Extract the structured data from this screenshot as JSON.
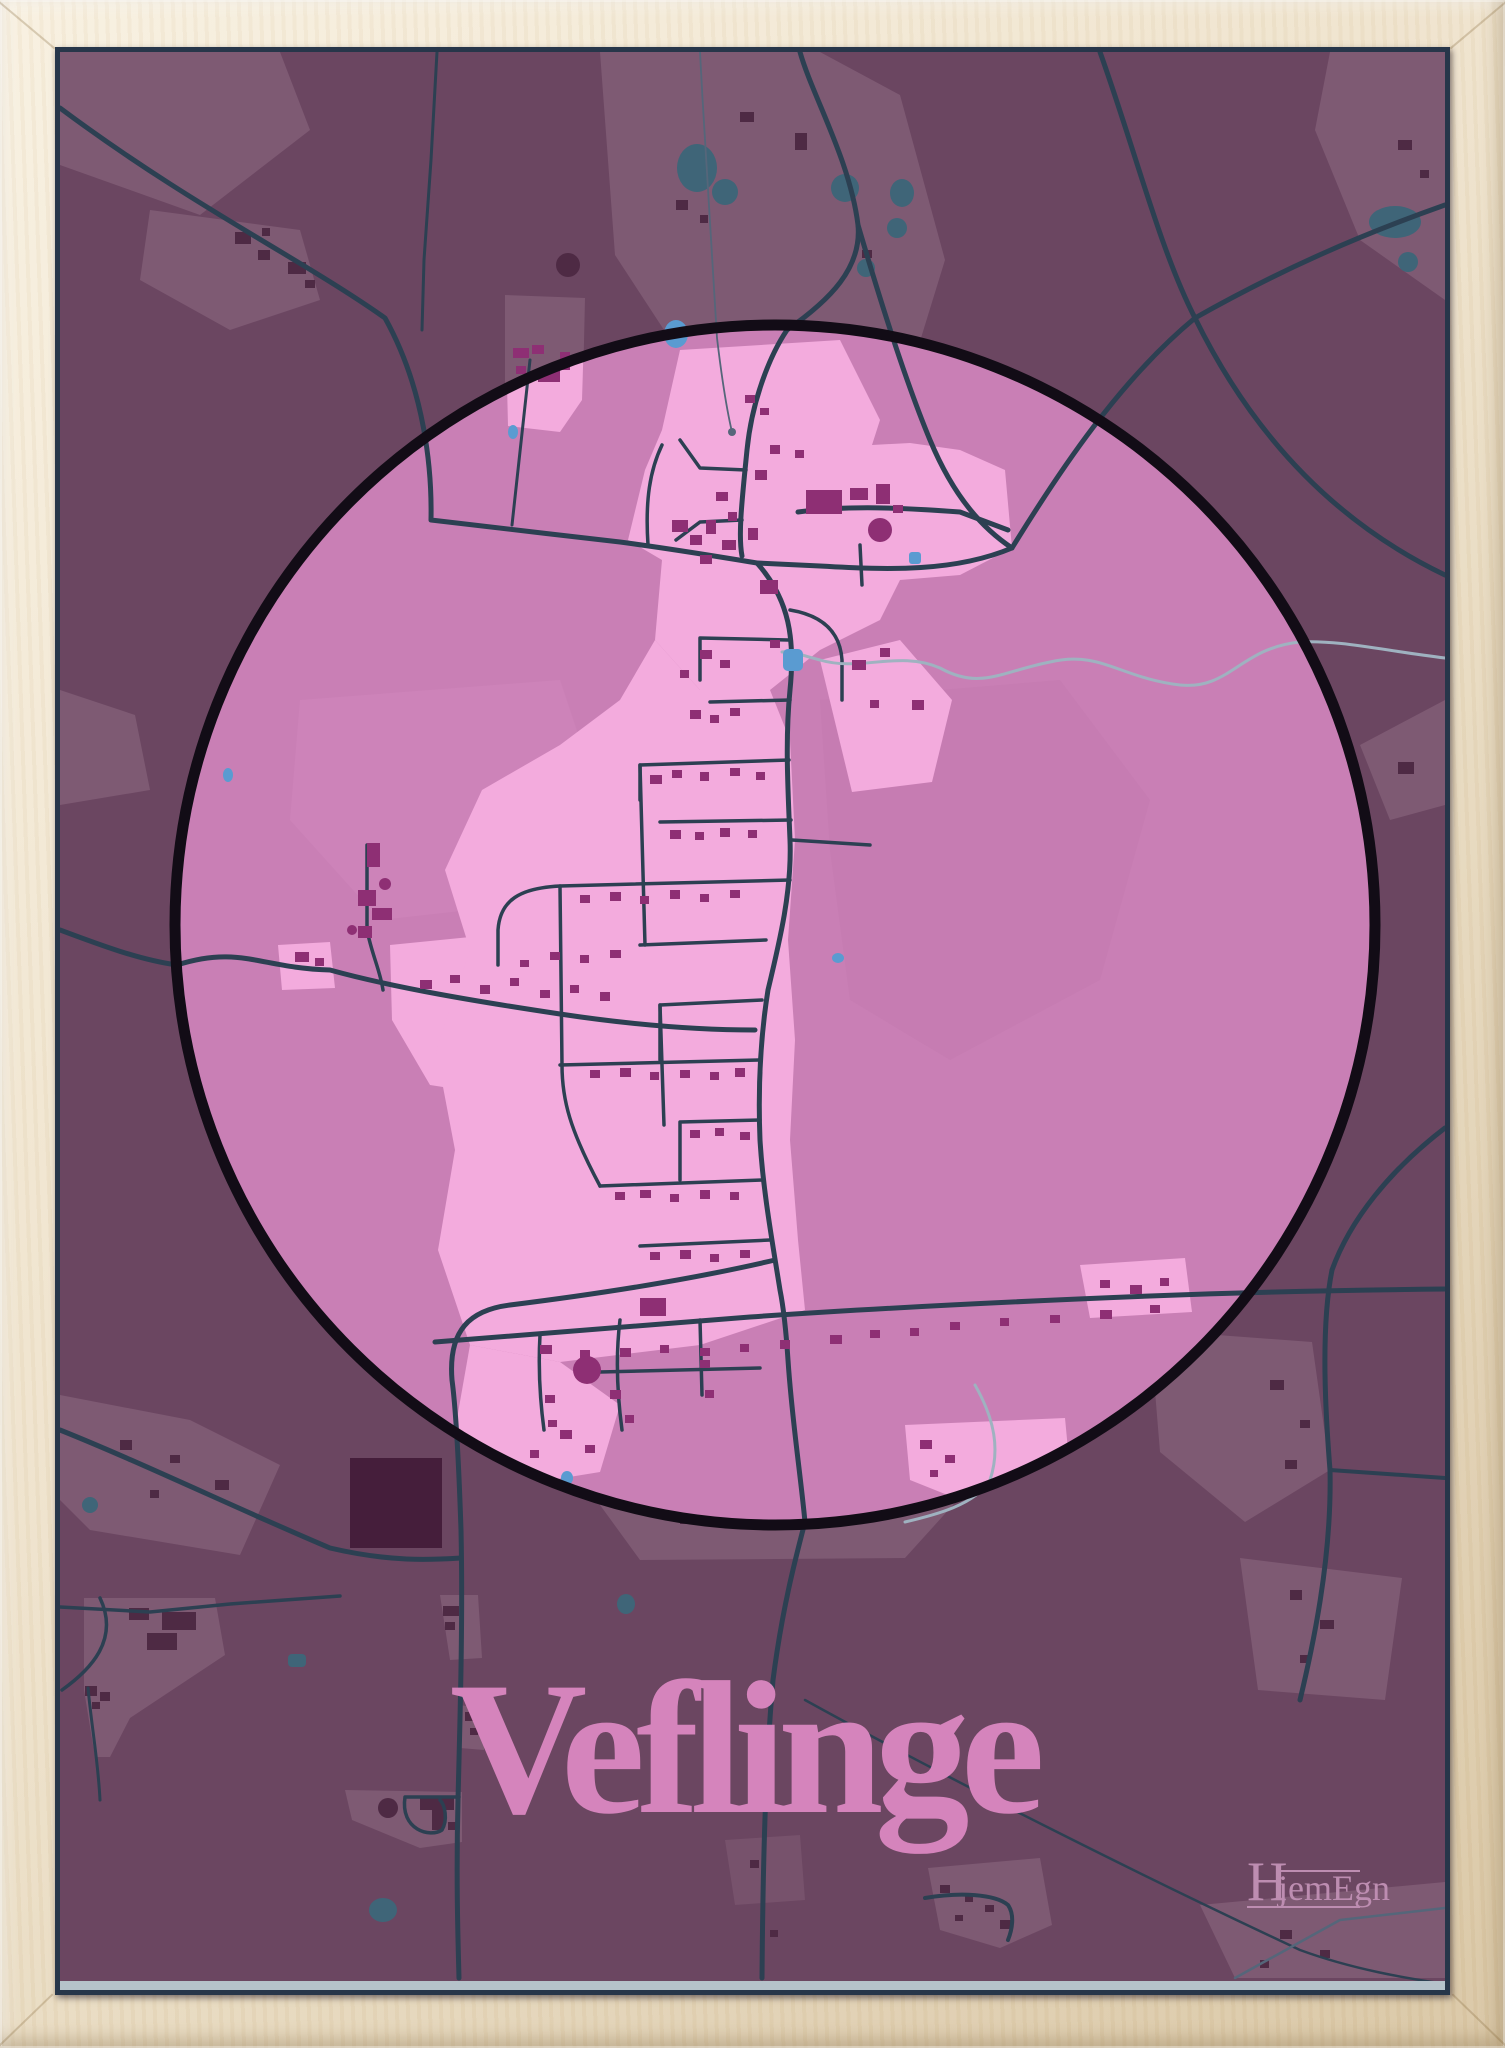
{
  "poster": {
    "title": "Veflinge",
    "brand": {
      "initial": "H",
      "rest": "jemEgn",
      "full": "HjemEgn"
    }
  },
  "map": {
    "kind": "town-map-poster",
    "place_name": "Veflinge",
    "focus_shape": "circle",
    "legend": "none"
  },
  "colors": {
    "frame_wood": "#eee2cb",
    "frame_wood_light": "#f8f0e0",
    "frame_wood_shadow": "#d9c6a4",
    "poster_bg": "#6b4661",
    "poster_edge": "#27364a",
    "poster_bottom_edge": "#b5c2ca",
    "countryside_patch": "#7e5a73",
    "countryside_building": "#4e2a44",
    "dark_block": "#451e3b",
    "road": "#2c4052",
    "road_minor": "#55667a",
    "stream": "#9fb2c0",
    "water_out": "#3f6578",
    "water_in": "#5a9bd1",
    "circle_fill": "#c97fb5",
    "circle_ring": "#120c16",
    "urban": "#f3abdd",
    "field_light": "#d38abf",
    "field_dark": "#c077ab",
    "town_building": "#8e2f74",
    "title": "#d584bc",
    "brand": "#bd8db1"
  }
}
